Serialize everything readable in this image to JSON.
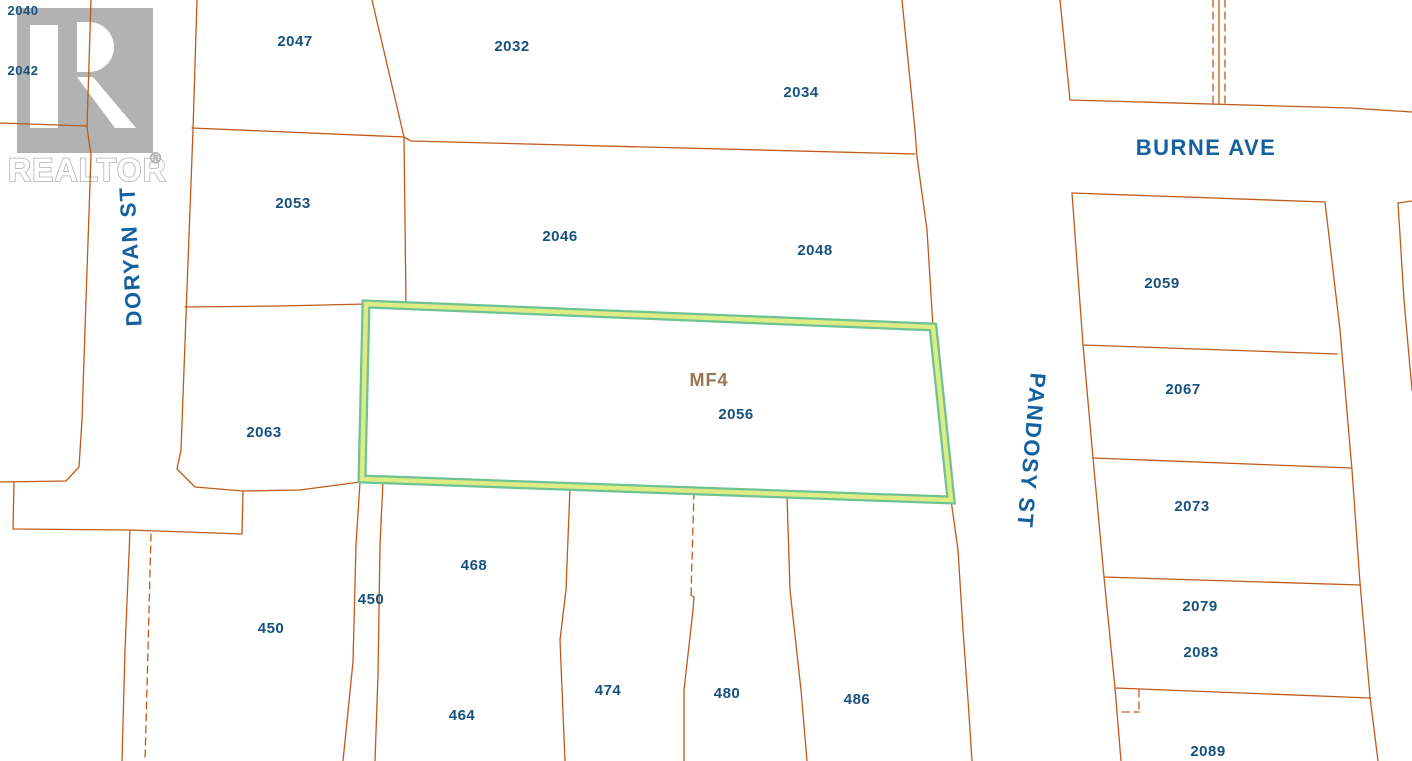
{
  "watermark": {
    "brand": "REALTOR",
    "registered_symbol": "®"
  },
  "streets": [
    {
      "name": "DORYAN ST"
    },
    {
      "name": "BURNE AVE"
    },
    {
      "name": "PANDOSY ST"
    }
  ],
  "highlighted_parcel": {
    "zone_code": "MF4",
    "lot_number": "2056"
  },
  "parcels": [
    {
      "label": "2040"
    },
    {
      "label": "2042"
    },
    {
      "label": "2047"
    },
    {
      "label": "2032"
    },
    {
      "label": "2034"
    },
    {
      "label": "2053"
    },
    {
      "label": "2046"
    },
    {
      "label": "2048"
    },
    {
      "label": "2063"
    },
    {
      "label": "450"
    },
    {
      "label": "450"
    },
    {
      "label": "468"
    },
    {
      "label": "464"
    },
    {
      "label": "474"
    },
    {
      "label": "480"
    },
    {
      "label": "486"
    },
    {
      "label": "2059"
    },
    {
      "label": "2067"
    },
    {
      "label": "2073"
    },
    {
      "label": "2079"
    },
    {
      "label": "2083"
    },
    {
      "label": "2089"
    }
  ],
  "colors": {
    "background": "#ffffff",
    "boundary_line": "#c05a1a",
    "lot_label": "#17527f",
    "street_label": "#1560a0",
    "zone_label": "#9b7350",
    "highlight_outer": "#6cc394",
    "highlight_inner": "#dfec83",
    "watermark_gray": "#b2b2b2",
    "watermark_glyph": "#ffffff"
  }
}
